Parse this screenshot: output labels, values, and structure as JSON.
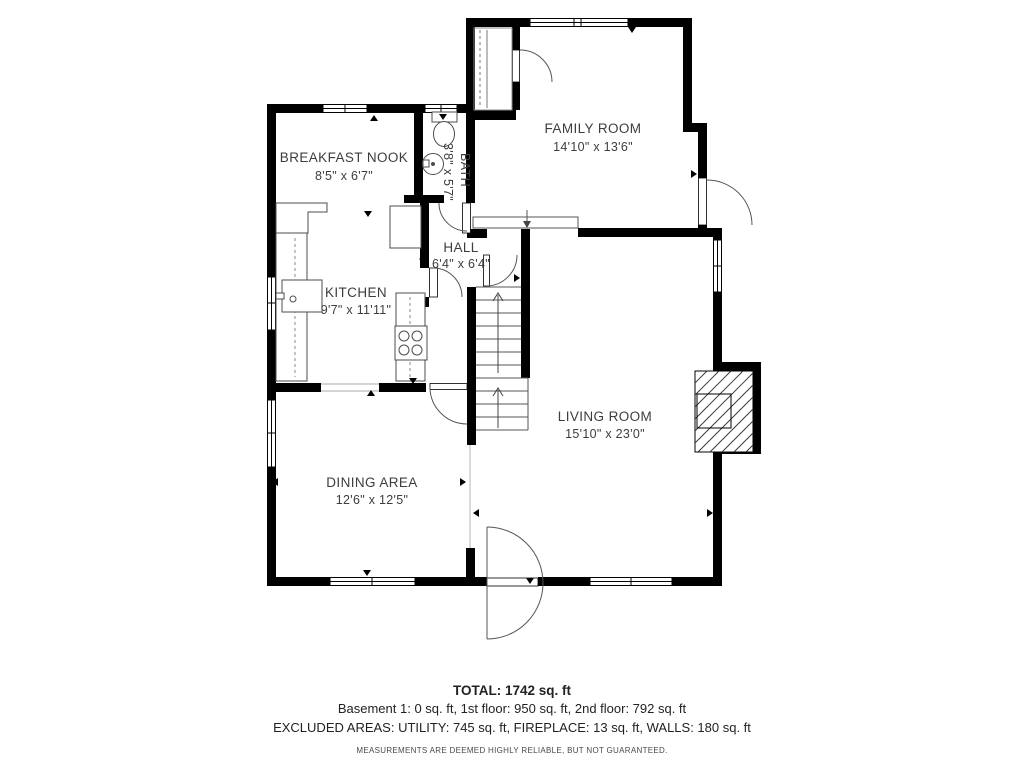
{
  "plan": {
    "rooms": [
      {
        "name": "BREAKFAST NOOK",
        "dims": "8'5\" x 6'7\""
      },
      {
        "name": "BATH",
        "dims": "3'8\" x 5'7\""
      },
      {
        "name": "FAMILY ROOM",
        "dims": "14'10\" x 13'6\""
      },
      {
        "name": "HALL",
        "dims": "6'4\" x 6'4\""
      },
      {
        "name": "KITCHEN",
        "dims": "9'7\" x 11'11\""
      },
      {
        "name": "LIVING ROOM",
        "dims": "15'10\" x 23'0\""
      },
      {
        "name": "DINING AREA",
        "dims": "12'6\" x 12'5\""
      }
    ],
    "colors": {
      "wall": "#000000",
      "label_text": "#3d3d3d",
      "fixture_line": "#4d4d4d"
    }
  },
  "summary": {
    "total": "TOTAL: 1742 sq. ft",
    "floors": "Basement 1: 0 sq. ft, 1st floor: 950 sq. ft, 2nd floor: 792 sq. ft",
    "excluded": "EXCLUDED AREAS: UTILITY: 745 sq. ft, FIREPLACE: 13 sq. ft, WALLS: 180 sq. ft",
    "disclaimer": "MEASUREMENTS ARE DEEMED HIGHLY RELIABLE, BUT NOT GUARANTEED."
  }
}
